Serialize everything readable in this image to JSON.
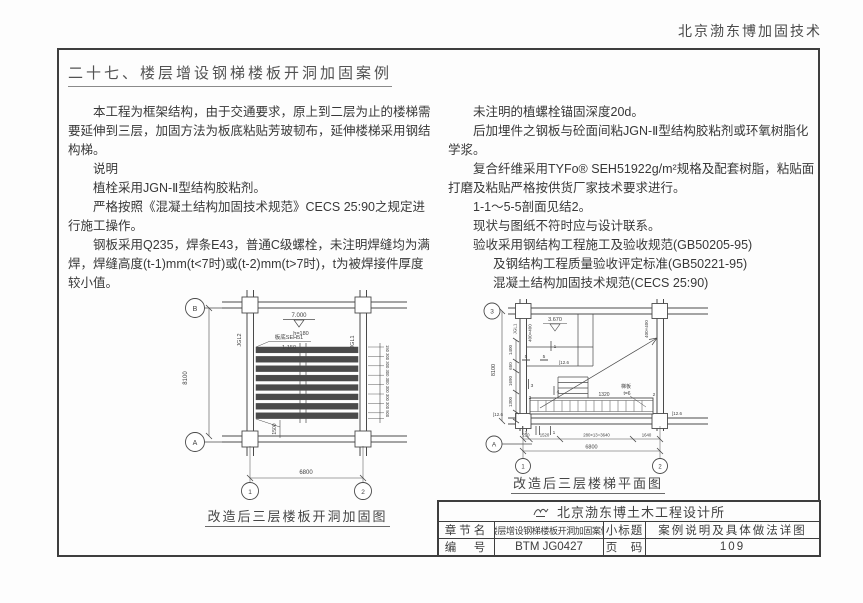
{
  "page": {
    "header": "北京渤东博加固技术",
    "title": "二十七、楼层增设钢梯楼板开洞加固案例"
  },
  "notes_left": {
    "p1": "本工程为框架结构，由于交通要求，原上到二层为止的楼梯需要延伸到三层，加固方法为板底粘贴芳玻韧布，延伸楼梯采用钢结构梯。",
    "p2": "说明",
    "p3": "植栓采用JGN-Ⅱ型结构胶粘剂。",
    "p4": "严格按照《混凝土结构加固技术规范》CECS 25:90之规定进行施工操作。",
    "p5": "钢板采用Q235，焊条E43，普通C级螺栓，未注明焊缝均为满焊，焊缝高度(t-1)mm(t<7时)或(t-2)mm(t>7时)，t为被焊接件厚度较小值。"
  },
  "notes_right": {
    "p1": "未注明的植螺栓锚固深度20d。",
    "p2": "后加埋件之钢板与砼面间粘JGN-Ⅱ型结构胶粘剂或环氧树脂化学浆。",
    "p3": "复合纤维采用TYFo® SEH51922g/m²规格及配套树脂，粘贴面打磨及粘贴严格按供货厂家技术要求进行。",
    "p4": "1-1～5-5剖面见结2。",
    "p5": "现状与图纸不符时应与设计联系。",
    "p6": "验收采用钢结构工程施工及验收规范(GB50205-95)",
    "p7": "及钢结构工程质量验收评定标准(GB50221-95)",
    "p8": "混凝土结构加固技术规范(CECS 25:90)"
  },
  "diagram_left": {
    "caption": "改造后三层楼板开洞加固图",
    "axis_b": "B",
    "axis_a": "A",
    "axis_1": "1",
    "axis_2": "2",
    "dim_height": "8100",
    "dim_width": "6800",
    "elev": "7.000",
    "slab_note": "h=180",
    "strip_label": "板底SEH51",
    "strip_spacing": "1-150",
    "beam_left": "JGL2",
    "beam_right": "JGL1",
    "dim_chain_right": "150 300 300 300 300 300 300 300 500",
    "dim_1500": "1500"
  },
  "diagram_right": {
    "caption": "改造后三层楼梯平面图",
    "axis_3": "3",
    "axis_a": "A",
    "axis_1": "1",
    "axis_2": "2",
    "dim_height": "8100",
    "dim_left_1": "1400",
    "dim_left_2": "650",
    "dim_left_3": "1690",
    "dim_left_4": "1300",
    "elev": "3.670",
    "col_label": "JGL1",
    "col_size_left": "400×400",
    "col_size_right": "400×400",
    "channel_1": "[12.6",
    "channel_2": "[12.6",
    "channel_3": "[12.6",
    "dim_1320": "1320",
    "tread_note_1": "梯板",
    "tread_note_2": "t=6",
    "marks": {
      "m5a": "5",
      "m5b": "5",
      "m1": "1",
      "m3": "3",
      "m2": "2",
      "m4": "4",
      "m2r": "2",
      "m3b": "3",
      "m1b": "1"
    },
    "dim_b1": "290",
    "dim_b2": "1520",
    "dim_b3": "280×13=3640",
    "dim_b4": "1640",
    "dim_width": "6800"
  },
  "titleblock": {
    "company": "北京渤东博土木工程设计所",
    "r1c1": "章节名",
    "r1c2": "楼层增设钢梯楼板开洞加固案例",
    "r1c3": "小标题",
    "r1c4": "案例说明及具体做法详图",
    "r2c1": "编　号",
    "r2c2": "BTM JG0427",
    "r2c3": "页　码",
    "r2c4": "109"
  }
}
